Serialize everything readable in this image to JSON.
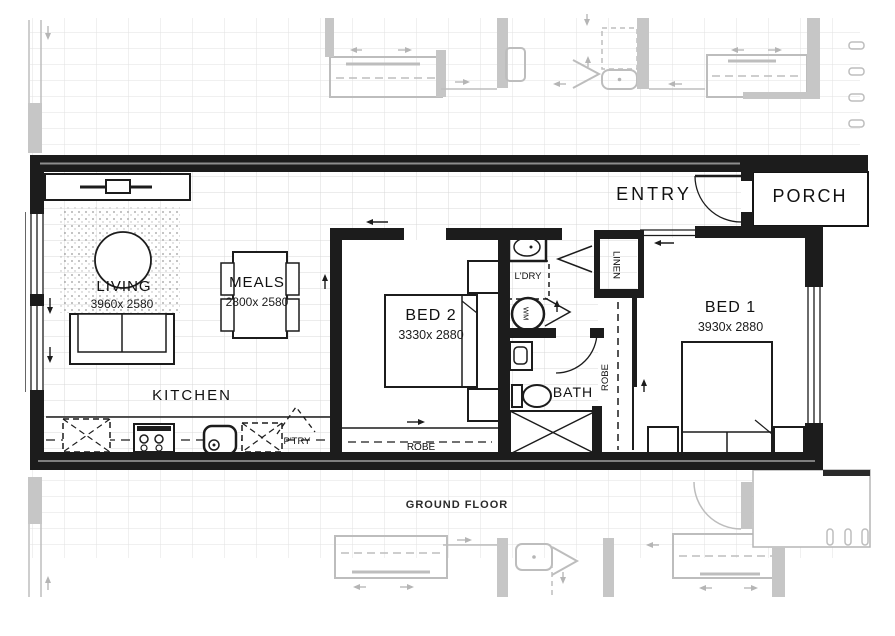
{
  "title": {
    "ground_floor": "GROUND FLOOR"
  },
  "rooms": {
    "living": {
      "label": "LIVING",
      "dims": "3960x 2580"
    },
    "meals": {
      "label": "MEALS",
      "dims": "2800x 2580"
    },
    "kitchen": {
      "label": "KITCHEN"
    },
    "bed2": {
      "label": "BED 2",
      "dims": "3330x 2880"
    },
    "bed1": {
      "label": "BED 1",
      "dims": "3930x 2880"
    },
    "entry": {
      "label": "ENTRY"
    },
    "porch": {
      "label": "PORCH"
    },
    "bath": {
      "label": "BATH"
    },
    "laundry": {
      "label": "L'DRY"
    },
    "pantry": {
      "label": "P'TRY"
    },
    "linen": {
      "label": "LINEN"
    },
    "robe_bed2": {
      "label": "ROBE"
    },
    "robe_bed1": {
      "label": "ROBE"
    },
    "washing_machine": {
      "label": "WM"
    }
  },
  "colors": {
    "wall": "#1c1c1c",
    "neighbor": "#bdbdbd",
    "neighbor_fill": "#c6c6c6",
    "grid_main": "#d9d9d9",
    "grid_neighbor": "#e2e2e2",
    "text": "#111111"
  }
}
